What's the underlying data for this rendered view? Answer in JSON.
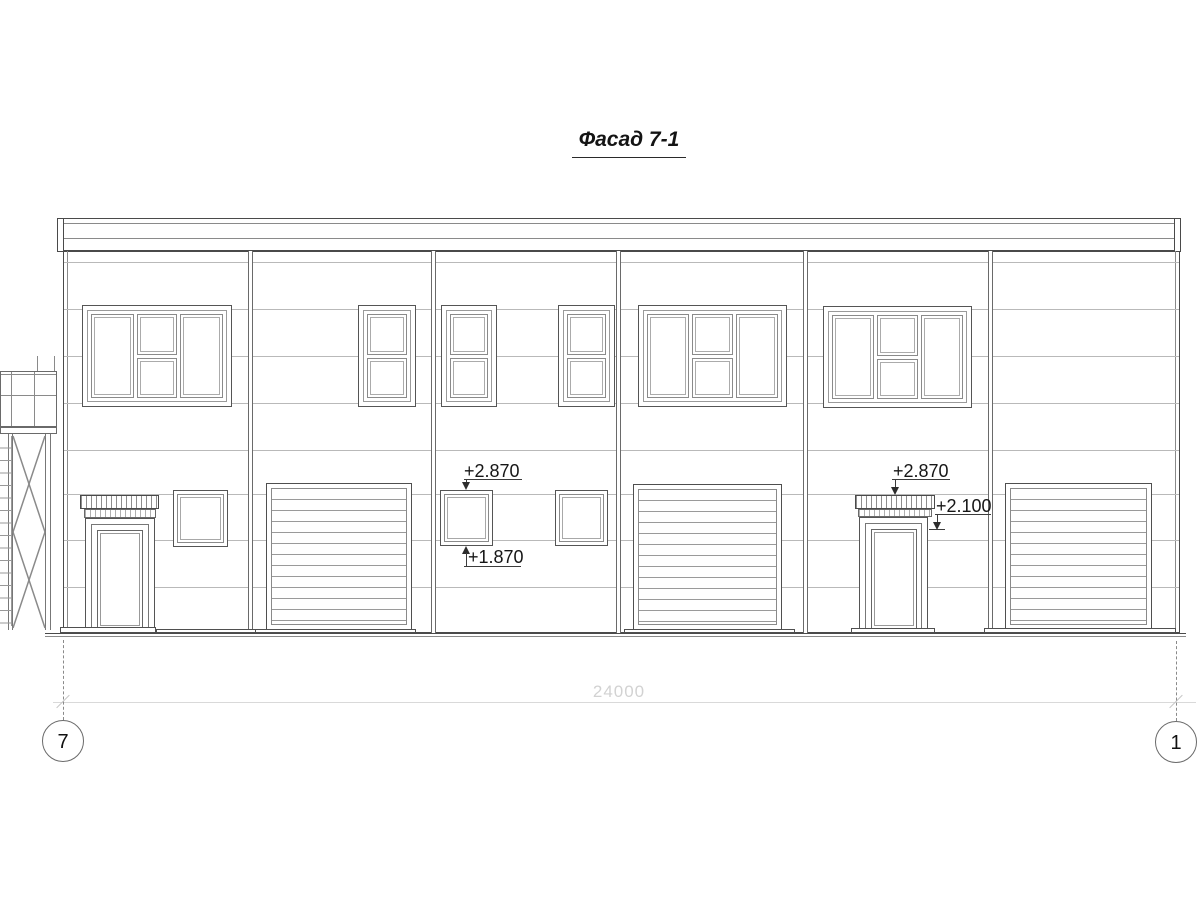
{
  "title": "Фасад 7-1",
  "annotations": {
    "left_window_top": "+2.870",
    "left_window_bottom": "+1.870",
    "right_canopy_top": "+2.870",
    "right_door_top": "+2.100"
  },
  "dimension": {
    "overall": "24000"
  },
  "axes": {
    "left": "7",
    "right": "1"
  },
  "colors": {
    "line_dark": "#4a4a4a",
    "line_mid": "#8a8a8a",
    "line_light": "#b9b9b9",
    "dimension_gray": "#d2d2d2"
  }
}
